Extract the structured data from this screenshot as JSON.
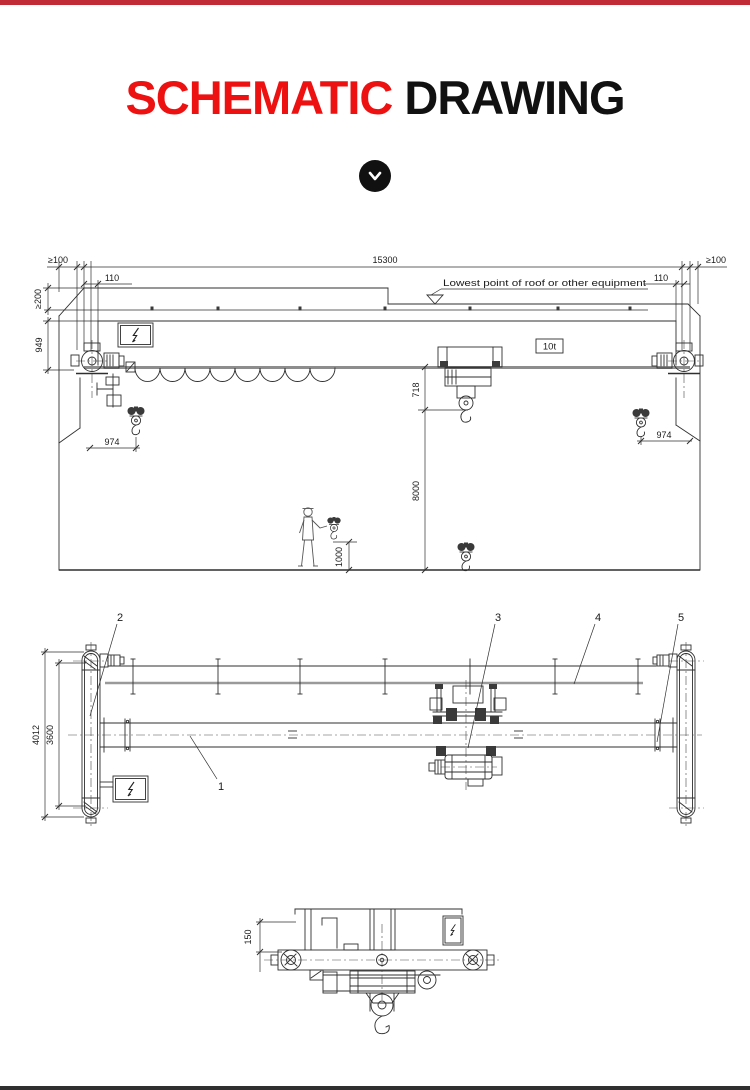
{
  "header": {
    "top_bar_color": "#c12b36",
    "title_primary": "SCHEMATIC",
    "title_secondary": "DRAWING",
    "title_primary_color": "#ee1111",
    "title_secondary_color": "#111111"
  },
  "scroll_indicator": {
    "icon": "chevron-down",
    "background": "#111111"
  },
  "elevation_view": {
    "span_dim": "15300",
    "side_clearance_left": "≥100",
    "side_clearance_right": "≥100",
    "top_clearance": "≥200",
    "end_clearance_left": "110",
    "end_clearance_right": "110",
    "crane_height_dim": "949",
    "hook_side_approach_left": "974",
    "hook_side_approach_right": "974",
    "girder_to_hook_dim": "718",
    "lifting_height_dim": "8000",
    "hook_min_height_dim": "1000",
    "capacity_badge": "10t",
    "roof_note": "Lowest point of roof or other equipment"
  },
  "plan_view": {
    "overall_width_dim": "4012",
    "wheelbase_dim": "3600",
    "part_label_girder": "1",
    "part_label_end_carriage": "2",
    "part_label_hoist_trolley": "3",
    "part_label_festoon_rail": "4",
    "part_label_travel_drive": "5"
  },
  "end_view": {
    "rail_height_dim": "150"
  }
}
